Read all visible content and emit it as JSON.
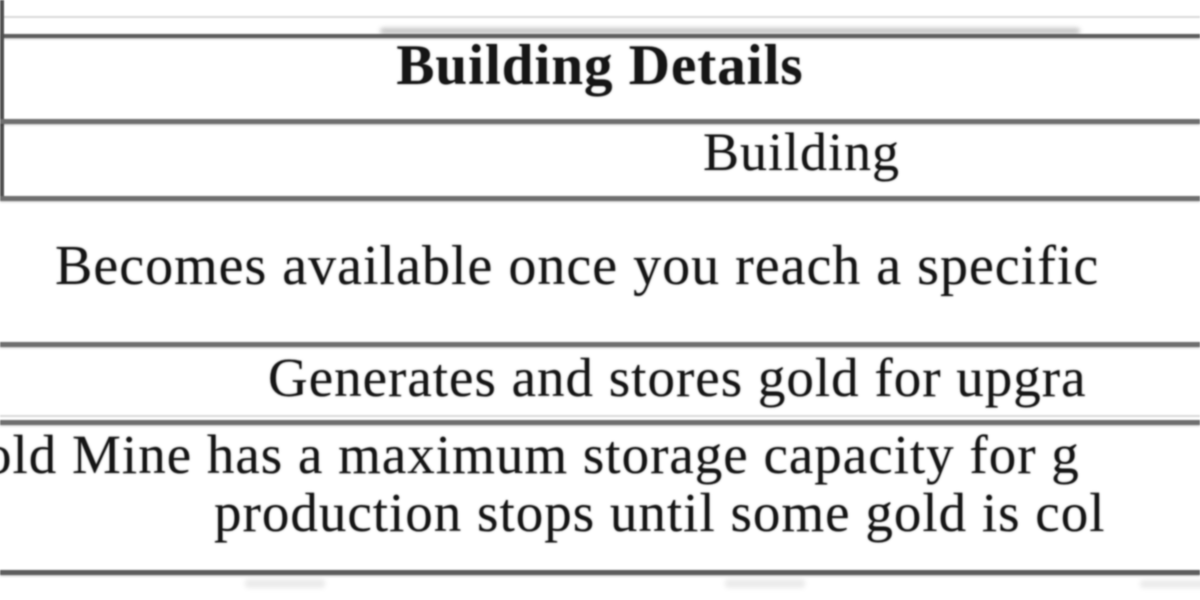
{
  "table": {
    "title": "Building Details",
    "column_header": "Building",
    "rows": {
      "availability": "Becomes available once you reach a specific",
      "function": "Generates and stores gold for upgra",
      "storage_line1": "old Mine has a maximum storage capacity for g",
      "storage_line2": "production stops until some gold is col"
    }
  },
  "colors": {
    "background": "#ffffff",
    "text": "#161616",
    "border_dark": "#5d5d5d",
    "border_mid": "#6f6f6f",
    "border_light": "#d9d9d9"
  }
}
